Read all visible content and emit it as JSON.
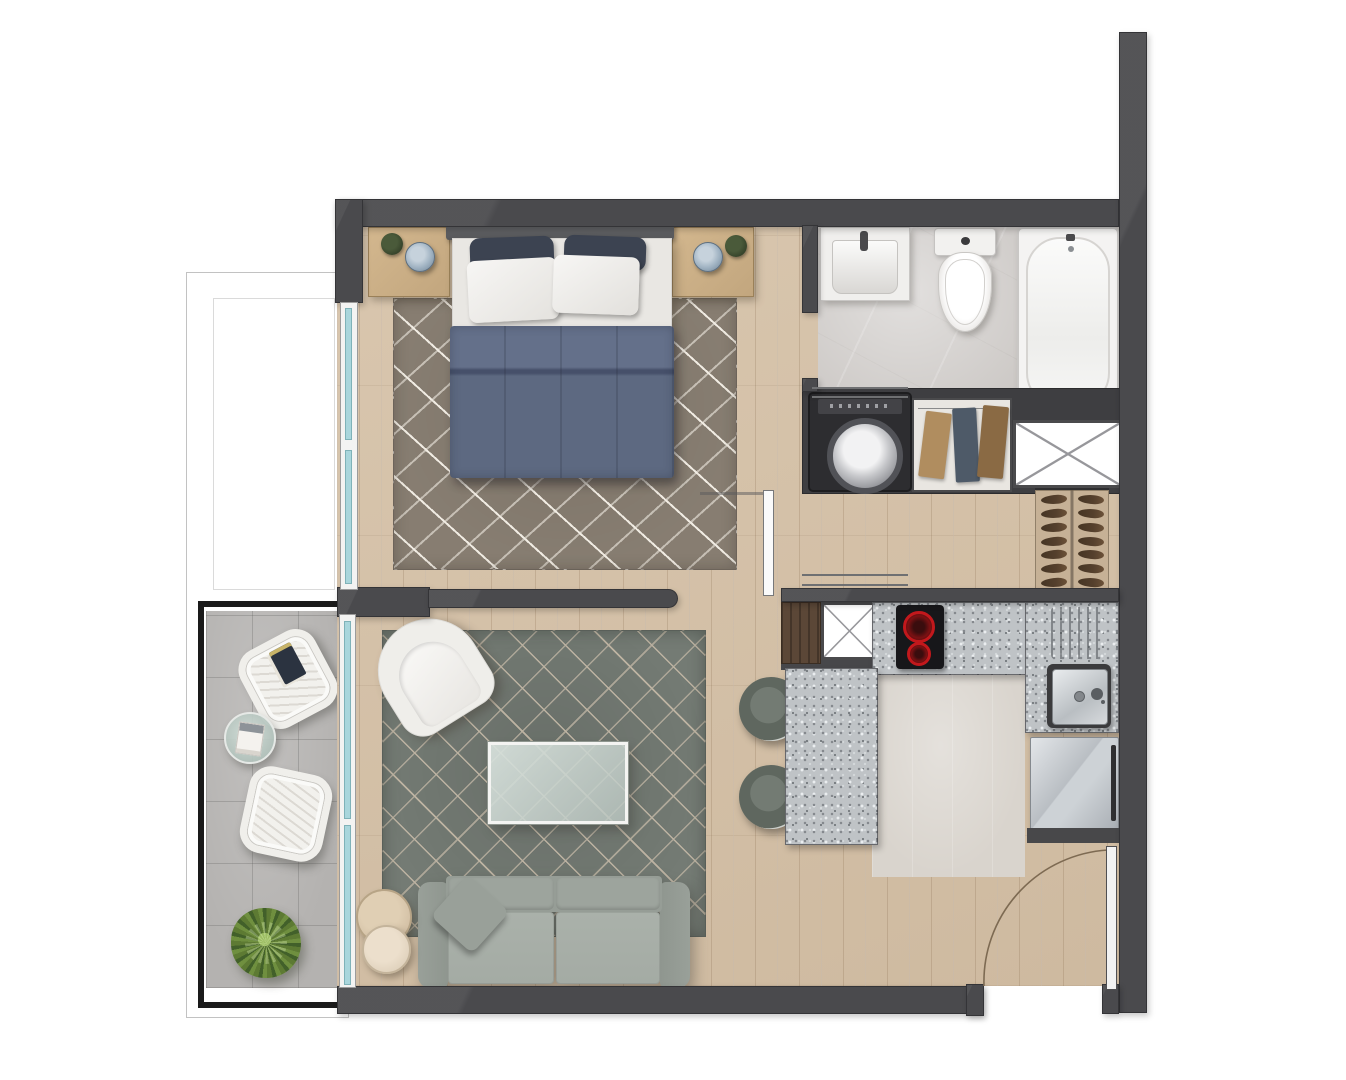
{
  "plan": {
    "type": "apartment-floor-plan",
    "view": "top-down-3d-render",
    "rooms": [
      {
        "name": "bedroom",
        "furniture": [
          "double-bed",
          "nightstand-left",
          "nightstand-right",
          "area-rug",
          "table-lamp",
          "potted-plant"
        ]
      },
      {
        "name": "bathroom",
        "furniture": [
          "washbasin",
          "toilet",
          "bathtub",
          "washing-machine",
          "linen-closet",
          "service-shaft"
        ]
      },
      {
        "name": "entry-hall",
        "furniture": [
          "shoe-rack",
          "sliding-door"
        ]
      },
      {
        "name": "kitchen",
        "furniture": [
          "cooktop",
          "kitchen-sink",
          "drainboard",
          "refrigerator",
          "peninsula-counter",
          "bar-stool",
          "bar-stool",
          "service-shaft",
          "tall-cabinet"
        ]
      },
      {
        "name": "living-room",
        "furniture": [
          "armchair",
          "coffee-table",
          "sofa",
          "nesting-side-tables",
          "area-rug",
          "throw-pillow"
        ]
      },
      {
        "name": "balcony",
        "furniture": [
          "lounge-chair",
          "lounge-chair",
          "glass-side-table",
          "potted-plant"
        ]
      }
    ],
    "counts": {
      "shoe_rack_rows": 7,
      "bar_stools": 2,
      "balcony_chairs": 2,
      "cooktop_burners": 2,
      "window_panes": 2,
      "glass_wall_panes": 2,
      "sofa_seats": 2,
      "bed_pillows": 4
    },
    "openings": [
      "entrance-door-swing-bottom-right",
      "bathroom-sliding-door",
      "bedroom-sliding-door",
      "balcony-glass-wall",
      "bedroom-window"
    ]
  },
  "colors": {
    "wall": "#4a4a4d",
    "wall_dark": "#343437",
    "wood": "#d6c2a8",
    "bath_tile": "#cac6c3",
    "kitchen_floor": "#d9d4cd",
    "balcony_tile": "#b4b2b0",
    "granite": "#bfc3c6",
    "rug_bedroom": "#877d71",
    "rug_bedroom_line": "#f0ebe2",
    "rug_living": "#747b74",
    "rug_living_line": "#bdb3a2",
    "sofa_base": "#8f968f",
    "sofa_seat": "#a4aba4",
    "armchair": "#efeeea",
    "duvet": "#64708a",
    "duvet_low": "#5d6981",
    "pillow_dark": "#3c4351",
    "glass": "#a9d6dc",
    "furniture_wood": "#c2a67e",
    "table_wood": "#d3c0a5",
    "cabinet_brown": "#5b4737",
    "stool_seat": "#5f675f",
    "burner_red": "#c2181c",
    "plant_green": "#5d7a33",
    "shoe_brown": "#55402d",
    "washer_body": "#2d2d30",
    "door_arc": "#7d6a52",
    "railing_black": "#1a1a1a",
    "shaft_x_line": "#97979b"
  }
}
